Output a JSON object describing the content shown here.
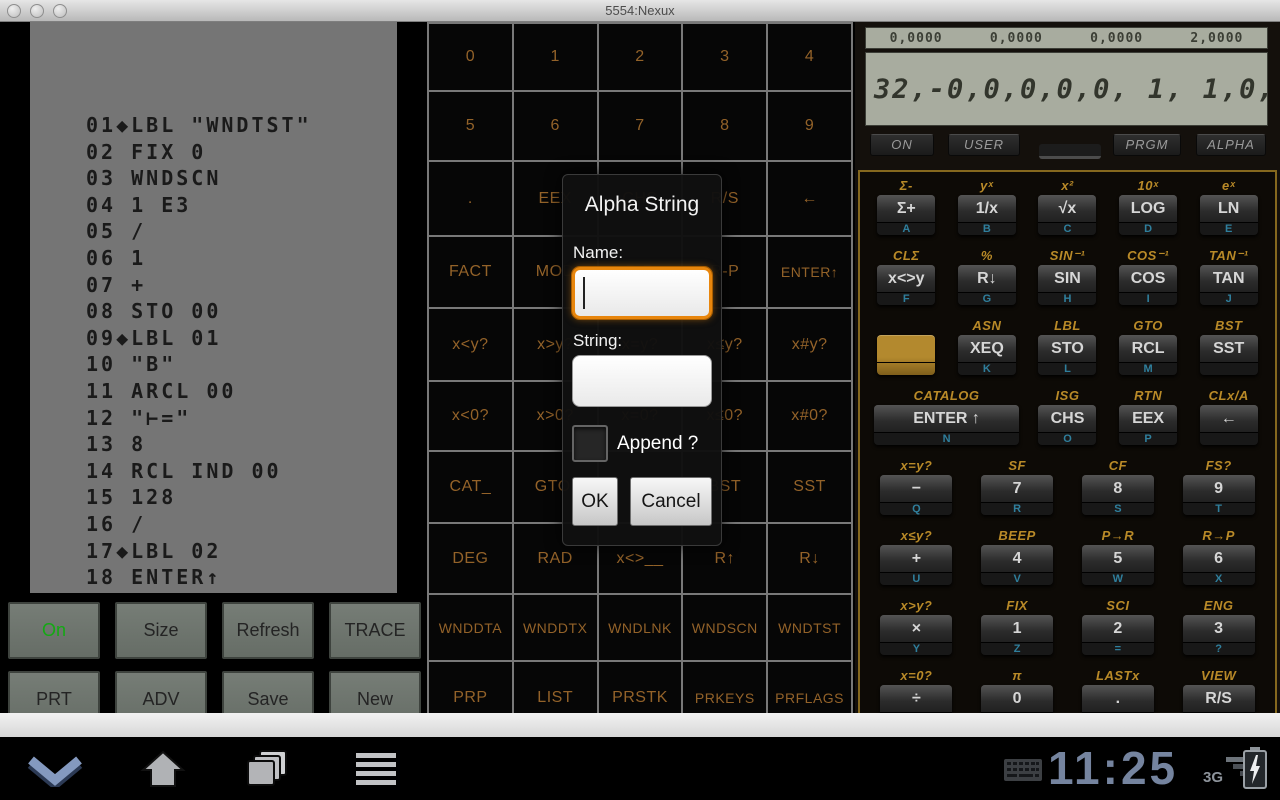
{
  "window": {
    "title": "5554:Nexux"
  },
  "printer": {
    "lines": [
      "01◆LBL \"WNDTST\"",
      "02 FIX 0",
      "03 WNDSCN",
      "04 1 E3",
      "05 /",
      "06 1",
      "07 +",
      "08 STO 00",
      "09◆LBL 01",
      "10 \"B\"",
      "11 ARCL 00",
      "12 \"⊢=\"",
      "13 8",
      "14 RCL IND 00",
      "15 128",
      "16 /",
      "17◆LBL 02",
      "18 ENTER↑",
      "19 FRC"
    ]
  },
  "function_grid": {
    "rows": [
      [
        "0",
        "1",
        "2",
        "3",
        "4"
      ],
      [
        "5",
        "6",
        "7",
        "8",
        "9"
      ],
      [
        ".",
        "EEX",
        "CHS",
        "R/S",
        "←"
      ],
      [
        "FACT",
        "MOD",
        "P-R",
        "R-P",
        "ENTER↑"
      ],
      [
        "x<y?",
        "x>y?",
        "x=y?",
        "x≤y?",
        "x#y?"
      ],
      [
        "x<0?",
        "x>0?",
        "x=0?",
        "x≤0?",
        "x#0?"
      ],
      [
        "CAT_",
        "GTO.",
        "",
        "BST",
        "SST"
      ],
      [
        "DEG",
        "RAD",
        "x<>__",
        "R↑",
        "R↓"
      ],
      [
        "WNDDTA",
        "WNDDTX",
        "WNDLNK",
        "WNDSCN",
        "WNDTST"
      ],
      [
        "PRP",
        "LIST",
        "PRSTK",
        "PRKEYS",
        "PRFLAGS"
      ]
    ]
  },
  "left_panel": {
    "rows": [
      [
        "On",
        "Size",
        "Refresh",
        "TRACE"
      ],
      [
        "PRT",
        "ADV",
        "Save",
        "New"
      ]
    ]
  },
  "dialog": {
    "title": "Alpha String",
    "name_label": "Name:",
    "name_value": "",
    "string_label": "String:",
    "string_value": "",
    "append_label": "Append ?",
    "ok_label": "OK",
    "cancel_label": "Cancel"
  },
  "calc": {
    "status_values": [
      "0,0000",
      "0,0000",
      "0,0000",
      "2,0000"
    ],
    "display": "32,-0,0,0,0,0, 1, 1,0,",
    "annunciator_buttons": [
      "ON",
      "USER",
      "PRGM",
      "ALPHA"
    ],
    "top_rows": [
      [
        {
          "shift": "Σ-",
          "key": "Σ+",
          "letter": "A"
        },
        {
          "shift": "yˣ",
          "key": "1/x",
          "letter": "B"
        },
        {
          "shift": "x²",
          "key": "√x",
          "letter": "C"
        },
        {
          "shift": "10ˣ",
          "key": "LOG",
          "letter": "D"
        },
        {
          "shift": "eˣ",
          "key": "LN",
          "letter": "E"
        }
      ],
      [
        {
          "shift": "CLΣ",
          "key": "x<>y",
          "letter": "F"
        },
        {
          "shift": "%",
          "key": "R↓",
          "letter": "G"
        },
        {
          "shift": "SIN⁻¹",
          "key": "SIN",
          "letter": "H"
        },
        {
          "shift": "COS⁻¹",
          "key": "COS",
          "letter": "I"
        },
        {
          "shift": "TAN⁻¹",
          "key": "TAN",
          "letter": "J"
        }
      ],
      [
        {
          "shift": "",
          "key": "",
          "letter": "",
          "type": "gold"
        },
        {
          "shift": "ASN",
          "key": "XEQ",
          "letter": "K"
        },
        {
          "shift": "LBL",
          "key": "STO",
          "letter": "L"
        },
        {
          "shift": "GTO",
          "key": "RCL",
          "letter": "M"
        },
        {
          "shift": "BST",
          "key": "SST",
          "letter": ""
        }
      ],
      [
        {
          "shift": "CATALOG",
          "key": "ENTER ↑",
          "letter": "N",
          "span": 2
        },
        {
          "shift": "ISG",
          "key": "CHS",
          "letter": "O"
        },
        {
          "shift": "RTN",
          "key": "EEX",
          "letter": "P"
        },
        {
          "shift": "CLx/A",
          "key": "←",
          "letter": ""
        }
      ]
    ],
    "bottom_rows": [
      [
        {
          "shift": "x=y?",
          "key": "−",
          "letter": "Q"
        },
        {
          "shift": "SF",
          "key": "7",
          "letter": "R"
        },
        {
          "shift": "CF",
          "key": "8",
          "letter": "S"
        },
        {
          "shift": "FS?",
          "key": "9",
          "letter": "T"
        }
      ],
      [
        {
          "shift": "x≤y?",
          "key": "+",
          "letter": "U"
        },
        {
          "shift": "BEEP",
          "key": "4",
          "letter": "V"
        },
        {
          "shift": "P→R",
          "key": "5",
          "letter": "W"
        },
        {
          "shift": "R→P",
          "key": "6",
          "letter": "X"
        }
      ],
      [
        {
          "shift": "x>y?",
          "key": "×",
          "letter": "Y"
        },
        {
          "shift": "FIX",
          "key": "1",
          "letter": "Z"
        },
        {
          "shift": "SCI",
          "key": "2",
          "letter": "="
        },
        {
          "shift": "ENG",
          "key": "3",
          "letter": "?"
        }
      ],
      [
        {
          "shift": "x=0?",
          "key": "÷",
          "letter": ","
        },
        {
          "shift": "π",
          "key": "0",
          "letter": "SPACE"
        },
        {
          "shift": "LASTx",
          "key": ".",
          "letter": ""
        },
        {
          "shift": "VIEW",
          "key": "R/S",
          "letter": ""
        }
      ]
    ]
  },
  "navbar": {
    "time": "11:25",
    "network": "3G"
  },
  "colors": {
    "on_button_green": "#13a913",
    "focus_orange": "#e8860d",
    "grid_text": "#936229",
    "shift_gold": "#b98a28",
    "key_letter_blue": "#2f7f9d",
    "clock_blue": "#75849f"
  }
}
